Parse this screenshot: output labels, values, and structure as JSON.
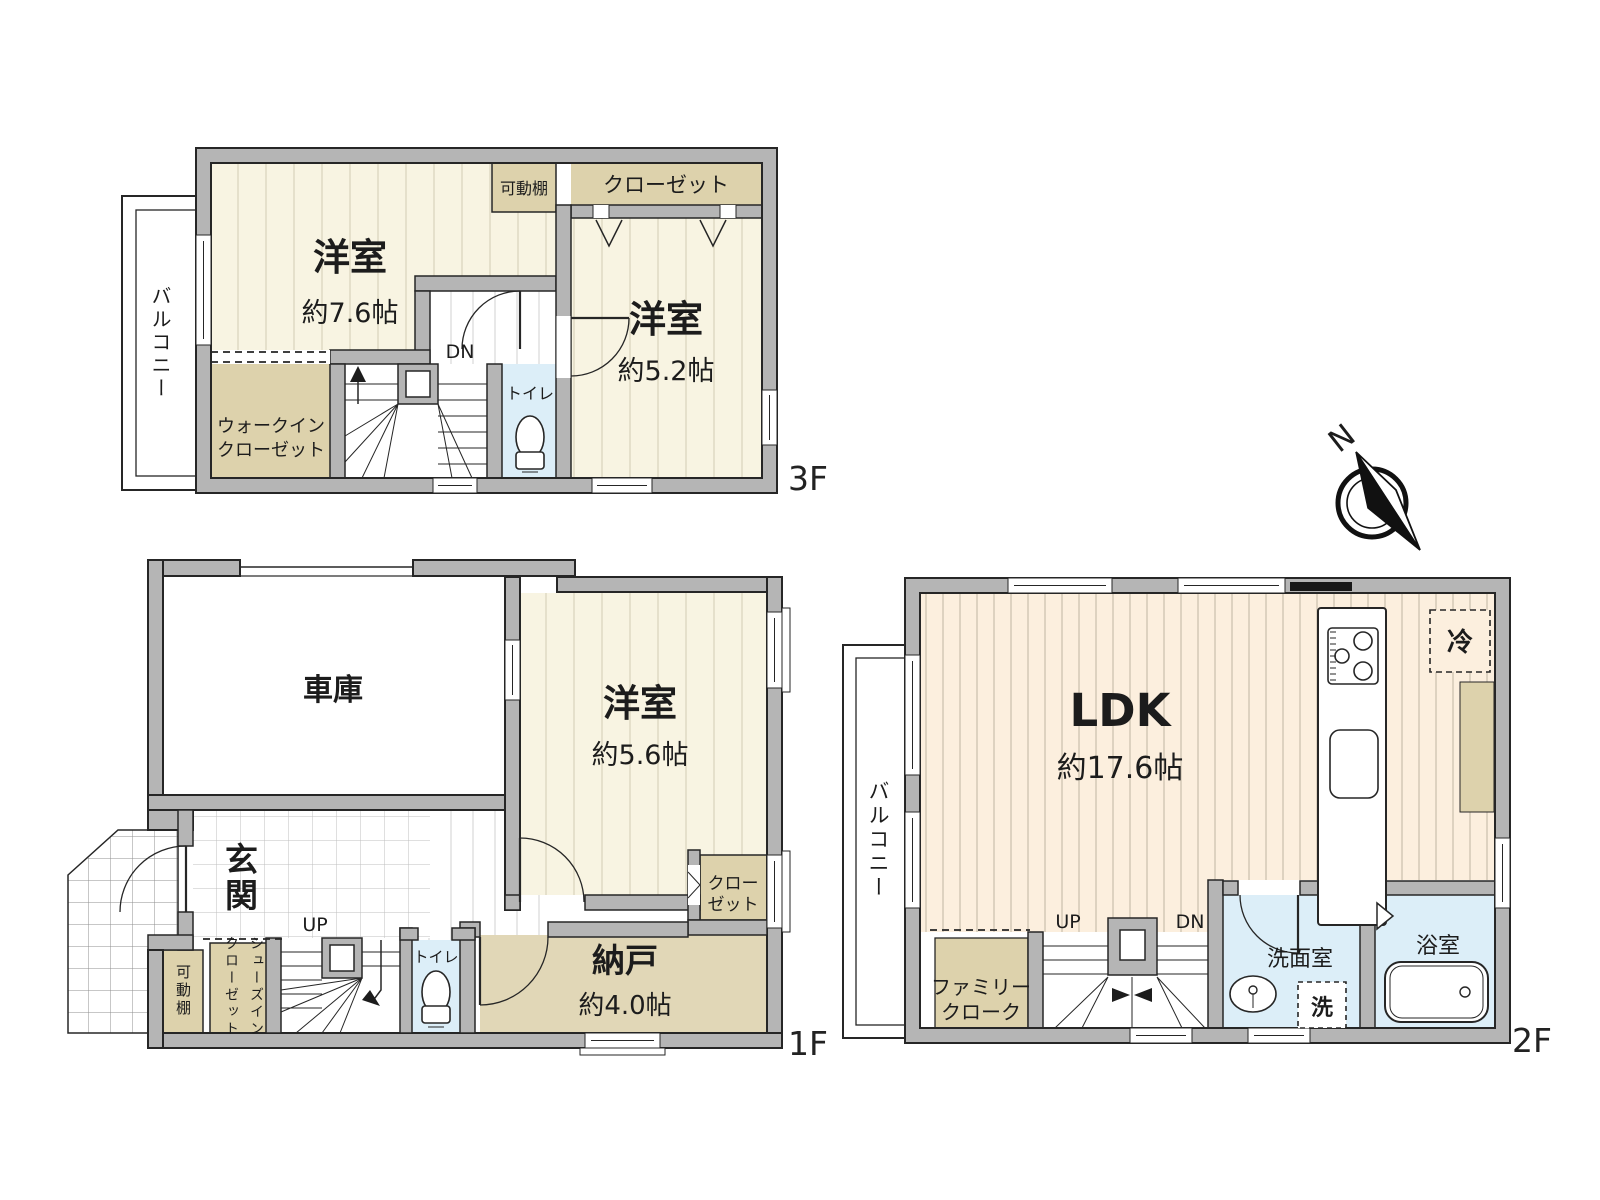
{
  "f3": {
    "floor_label": "3F",
    "balcony": "バルコニー",
    "room1_name": "洋室",
    "room1_size": "約7.6帖",
    "shelf": "可動棚",
    "closet": "クローゼット",
    "room2_name": "洋室",
    "room2_size": "約5.2帖",
    "dn": "DN",
    "toilet": "トイレ",
    "wic_line1": "ウォークイン",
    "wic_line2": "クローゼット"
  },
  "f1": {
    "floor_label": "1F",
    "garage": "車庫",
    "room_name": "洋室",
    "room_size": "約5.6帖",
    "closet_line1": "クロー",
    "closet_line2": "ゼット",
    "storage_name": "納戸",
    "storage_size": "約4.0帖",
    "entrance": "玄関",
    "up": "UP",
    "toilet": "トイレ",
    "shelf": "可動棚",
    "sic_line1": "シューズイン",
    "sic_line2": "クローゼット"
  },
  "f2": {
    "floor_label": "2F",
    "balcony": "バルコニー",
    "ldk_name": "LDK",
    "ldk_size": "約17.6帖",
    "fridge": "冷",
    "family_line1": "ファミリー",
    "family_line2": "クローク",
    "up": "UP",
    "dn": "DN",
    "washroom": "洗面室",
    "laundry": "洗",
    "bathroom": "浴室"
  },
  "compass": {
    "north": "N"
  },
  "colors": {
    "wall": "#b5b5b5",
    "room_cream": "#f8f4e2",
    "ldk_peach": "#fcefde",
    "closet_tan": "#ddd2ac",
    "storage_tan": "#e1d7b7",
    "wet_blue": "#dceef8"
  }
}
